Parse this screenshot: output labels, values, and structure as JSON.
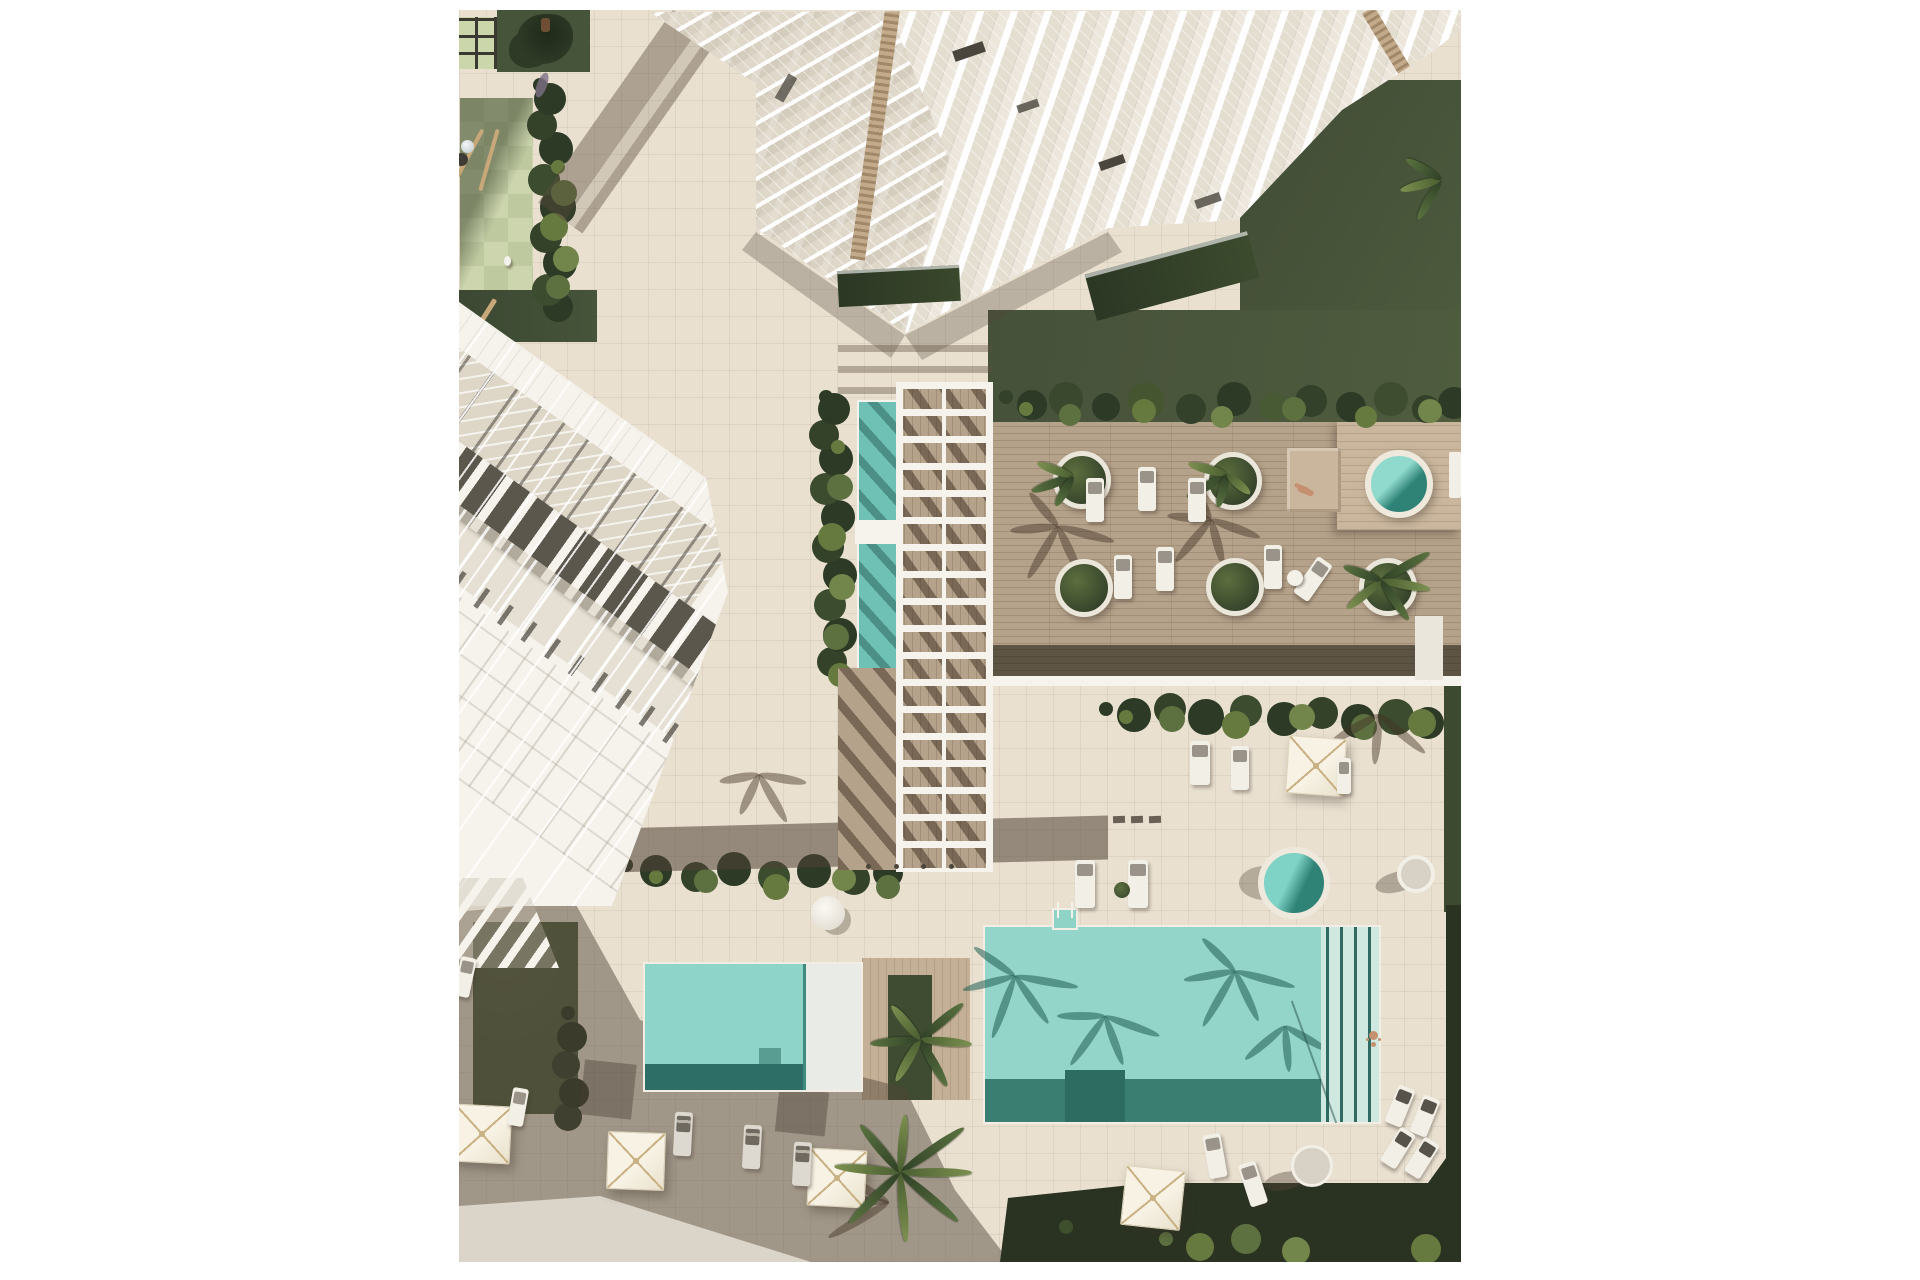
{
  "meta": {
    "title": "Aerial architectural rendering of a resort residential complex",
    "view": "top-down 3d render",
    "visible_text": ""
  },
  "palette": {
    "page": "#ffffff",
    "pavement": "#e9e0d0",
    "pavement_line": "rgba(120,104,84,0.10)",
    "walkway": "#dad4c9",
    "wood_deck": "#b5a28a",
    "wood_platform": "#c9b69d",
    "wood_dark": "#57503f",
    "building_white": "#f6f3ec",
    "umbrella_cream": "#f3ecdb",
    "umbrella_rib": "#c9b183",
    "glazing": "#ded6c7",
    "panel_dark": "#5c574c",
    "louver_wood": "#c2aa8a",
    "lawn": "#49543a",
    "hedge_dark": "#2d3a26",
    "hedge_mid": "#455734",
    "leaf_light": "#66793f",
    "pool_light": "#9cdad0",
    "pool_mid": "#79c8bb",
    "pool_shadow": "#3f8578",
    "pool_deep": "#2d6e64",
    "pool_shelf": "#cfe8e0",
    "spa_water": "#7ed2c6",
    "spa_deep": "#2e8276",
    "shadow": "rgba(84,71,58,0.48)",
    "shadow_soft": "rgba(84,71,58,0.30)",
    "plant_dark": "#2a3322",
    "grass_patch": "#4a5839",
    "skin": "#c69070",
    "checker_a": "#ccd5ad",
    "checker_b": "#bfc9a0"
  },
  "scene": {
    "areas": [
      {
        "label": "white tower with cascading balconies",
        "position": "top-center"
      },
      {
        "label": "white townhouse block with dark roof panels",
        "position": "left"
      },
      {
        "label": "playground with pale green checker tiles",
        "position": "top-left"
      },
      {
        "label": "white pergola over wood walkway with lap pool",
        "position": "center"
      },
      {
        "label": "wood lounge deck with round planters and spa",
        "position": "center-right"
      },
      {
        "label": "main swimming pool with lap lanes",
        "position": "bottom-center"
      },
      {
        "label": "kids pool with white shelf",
        "position": "bottom-left"
      },
      {
        "label": "garden planting band and walkway",
        "position": "bottom edge"
      }
    ],
    "counts": {
      "pools": 4,
      "hot_tubs": 2,
      "round_planters": 5,
      "umbrellas": 5,
      "sun_loungers": 22,
      "people": 3,
      "palm_trees": 4
    }
  }
}
